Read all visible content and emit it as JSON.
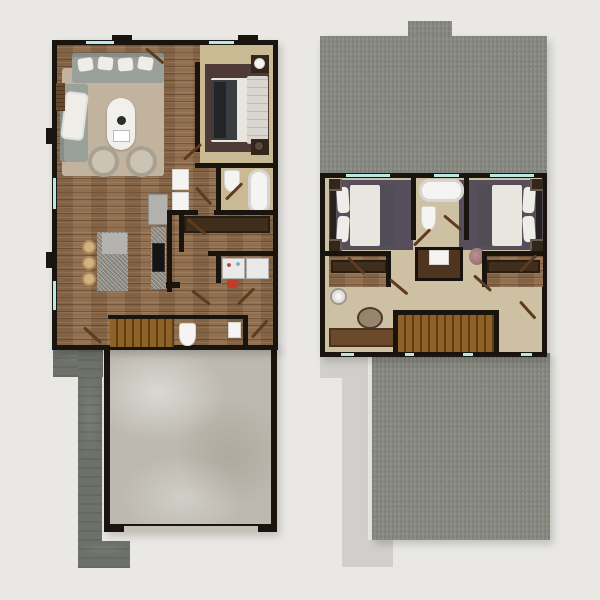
{
  "scene": {
    "type": "architectural-floor-plan-rendering",
    "views": [
      {
        "name": "first-floor",
        "rooms": [
          "living-room",
          "kitchen",
          "bedroom",
          "bathroom",
          "vanity-nook",
          "walk-in-closet",
          "laundry",
          "powder-room",
          "stairs",
          "garage",
          "driveway-walkway"
        ],
        "furniture": [
          "sectional-sofa",
          "coffee-table",
          "accent-chairs",
          "area-rug",
          "bed",
          "nightstands-with-lamps",
          "kitchen-island",
          "bar-stools",
          "refrigerator",
          "cooktop-counter",
          "washer",
          "dryer",
          "freestanding-tub",
          "toilets",
          "vanity-cabinets"
        ]
      },
      {
        "name": "second-floor",
        "rooms": [
          "bedroom-left",
          "bedroom-right",
          "bathroom",
          "closet-left",
          "closet-right",
          "hallway",
          "stairs",
          "upper-roof",
          "garage-roof",
          "walkway-outline"
        ],
        "furniture": [
          "beds",
          "nightstands",
          "area-rugs",
          "freestanding-tub",
          "toilet",
          "vanity-with-sink",
          "console-table",
          "basket",
          "ceiling-fixture",
          "pink-chair"
        ]
      }
    ]
  },
  "colors": {
    "background": "#e9e8e5",
    "wall": "#1a140e",
    "wood": "#8a6848",
    "carpet1": "#c9ba94",
    "carpet2": "#cec0a2",
    "living-rug": "#c2b39e",
    "bedroom-rug": "#4e3a36",
    "plum-rug": "#574e5b",
    "sofa": "#9aa19b",
    "pillow": "#efede7",
    "table": "#f2f0ec",
    "chair": "#cbc4b4",
    "chair-rim": "#a8a191",
    "granite": "#97938b",
    "granite-top": "#b5b3af",
    "appliance": "#b3b1ad",
    "cooktop": "#141414",
    "stool": "#d2b183",
    "stool-rim": "#b08c5a",
    "fixture": "#f5f4f2",
    "fixture-rim": "#d8d5d1",
    "shelf": "#3f2d1d",
    "stair": "#8e6227",
    "stair-dark": "#5f3d13",
    "concrete": "#bdb9b0",
    "walk-dark": "#6e716a",
    "walk-light": "#d0cfcb",
    "roof": "#8b8d85",
    "window": "#b9e6e8",
    "swing": "#5d3b1f",
    "bedding": "#e9e6e0",
    "blanket": "#3b3e41",
    "blanket2": "#514d57",
    "headboard": "#d9d6cf",
    "headboard-dark": "#26211f",
    "nightstand": "#33261b",
    "vanity-dark": "#17120d",
    "vanity-wood": "#4f351f",
    "console": "#6b4a2b",
    "basket": "#96846d",
    "basket-dark": "#4a3c2c",
    "chair-pink": "#bb8f8f",
    "washer": "#e9e9e7",
    "basket-red": "#c23b2c",
    "door-band": "#c6c2b9"
  }
}
